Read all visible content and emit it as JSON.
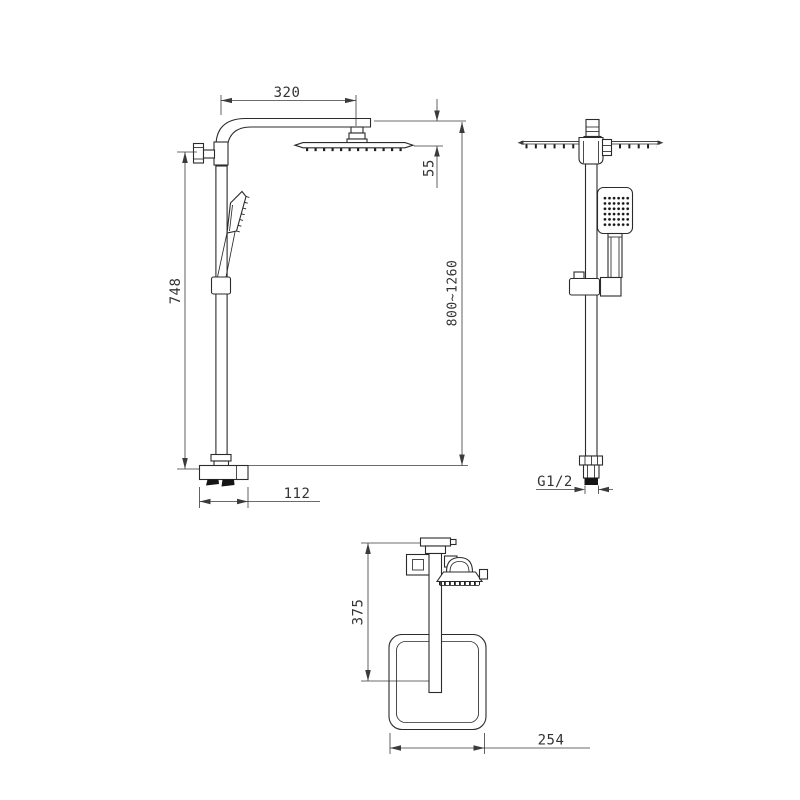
{
  "drawing": {
    "type": "technical-dimension-drawing",
    "subject": "thermostatic shower column with square rain head and hand shower",
    "colors": {
      "background": "#ffffff",
      "line": "#2b2b2b",
      "dimension_text": "#333333"
    },
    "front": {
      "arm_length": "320",
      "head_drop": "55",
      "rail_height": "748",
      "valve_width": "112",
      "height_range": "800~1260"
    },
    "side": {
      "inlet_thread": "G1/2"
    },
    "top": {
      "arm_projection": "375",
      "head_width": "254"
    }
  }
}
